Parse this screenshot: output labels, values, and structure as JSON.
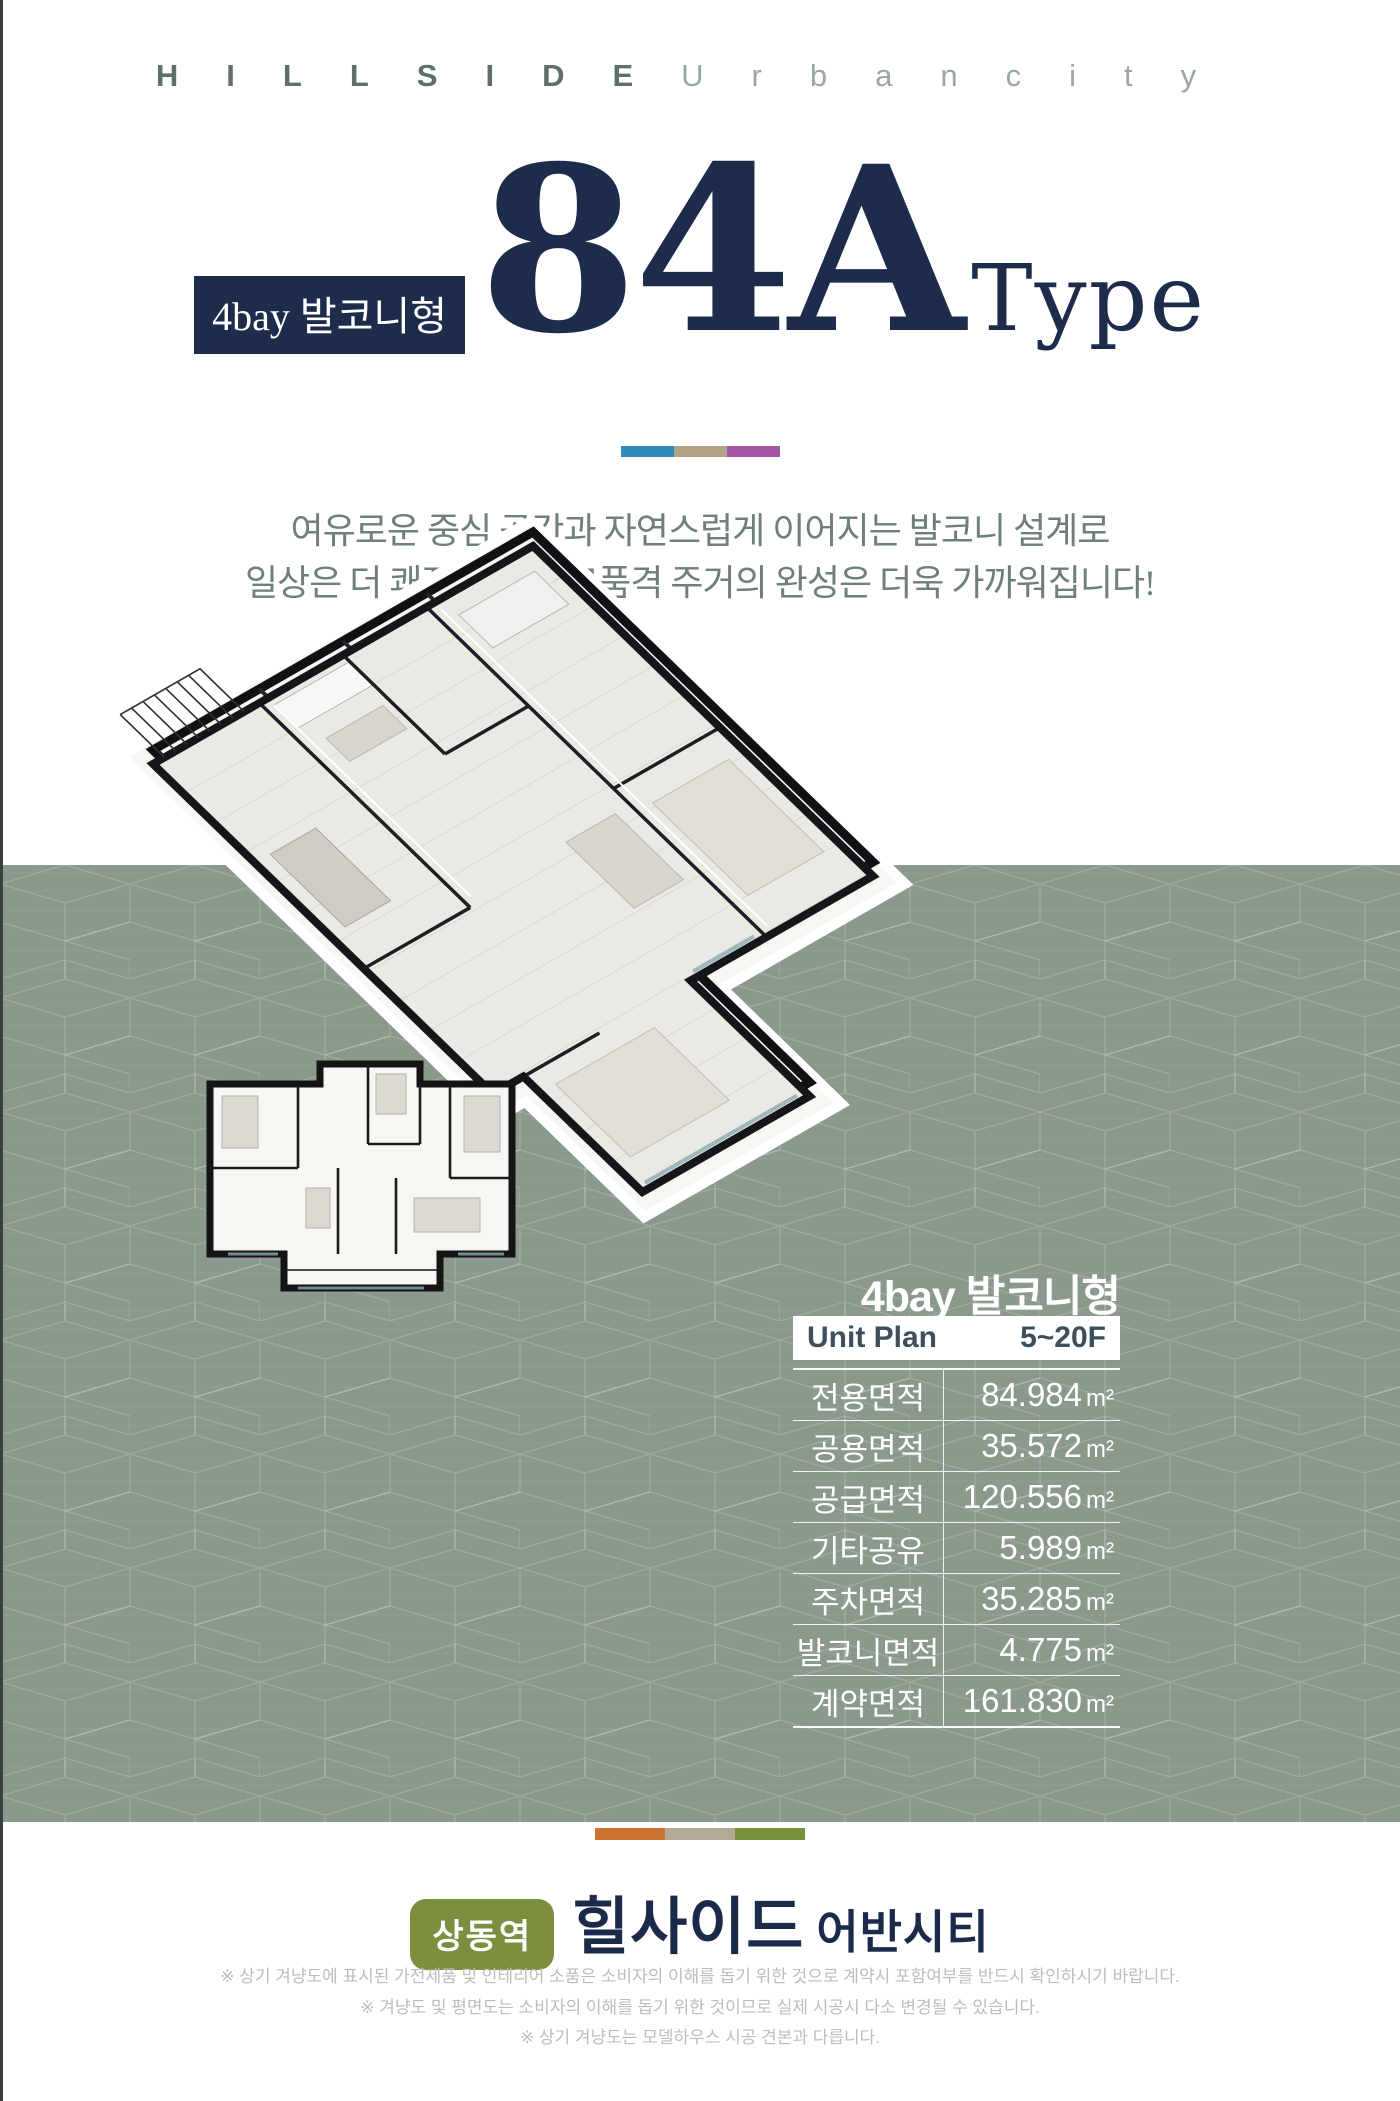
{
  "header": {
    "brand_bold": "HILLSIDE",
    "brand_light": "Urbancity"
  },
  "title": {
    "badge": "4bay 발코니형",
    "main": "84A",
    "suffix": "Type"
  },
  "colors": {
    "navy": "#1e2c4c",
    "sage_band": "#8a998c",
    "top_divider_1": "#2f8cba",
    "top_divider_2": "#b2a287",
    "top_divider_3": "#a757a3",
    "bottom_divider_1": "#cc7231",
    "bottom_divider_2": "#b3a995",
    "bottom_divider_3": "#78903a",
    "station_badge_bg": "#7b8f3e"
  },
  "intro": {
    "line1": "여유로운 중심 공간과 자연스럽게 이어지는 발코니 설계로",
    "line2": "일상은 더 쾌적해지고, 고품격 주거의 완성은 더욱 가까워집니다!"
  },
  "unit_info": {
    "heading": "4bay 발코니형",
    "plan_label": "Unit Plan",
    "floors": "5~20F",
    "rows": [
      {
        "label": "전용면적",
        "value": "84.984",
        "unit": "m²"
      },
      {
        "label": "공용면적",
        "value": "35.572",
        "unit": "m²"
      },
      {
        "label": "공급면적",
        "value": "120.556",
        "unit": "m²"
      },
      {
        "label": "기타공유",
        "value": "5.989",
        "unit": "m²"
      },
      {
        "label": "주차면적",
        "value": "35.285",
        "unit": "m²"
      },
      {
        "label": "발코니면적",
        "value": "4.775",
        "unit": "m²"
      },
      {
        "label": "계약면적",
        "value": "161.830",
        "unit": "m²"
      }
    ]
  },
  "footer": {
    "station_badge": "상동역",
    "brand_main": "힐사이드",
    "brand_sub": "어반시티",
    "disclaimer_1": "※ 상기 겨냥도에 표시된 가전제품 및 인테리어 소품은 소비자의 이해를 돕기 위한 것으로 계약시 포함여부를 반드시 확인하시기 바랍니다.",
    "disclaimer_2": "※ 겨냥도 및 평면도는 소비자의 이해를 돕기 위한 것이므로 실제 시공시 다소 변경될 수 있습니다.",
    "disclaimer_3": "※ 상기 겨냥도는 모델하우스 시공 견본과 다릅니다."
  }
}
